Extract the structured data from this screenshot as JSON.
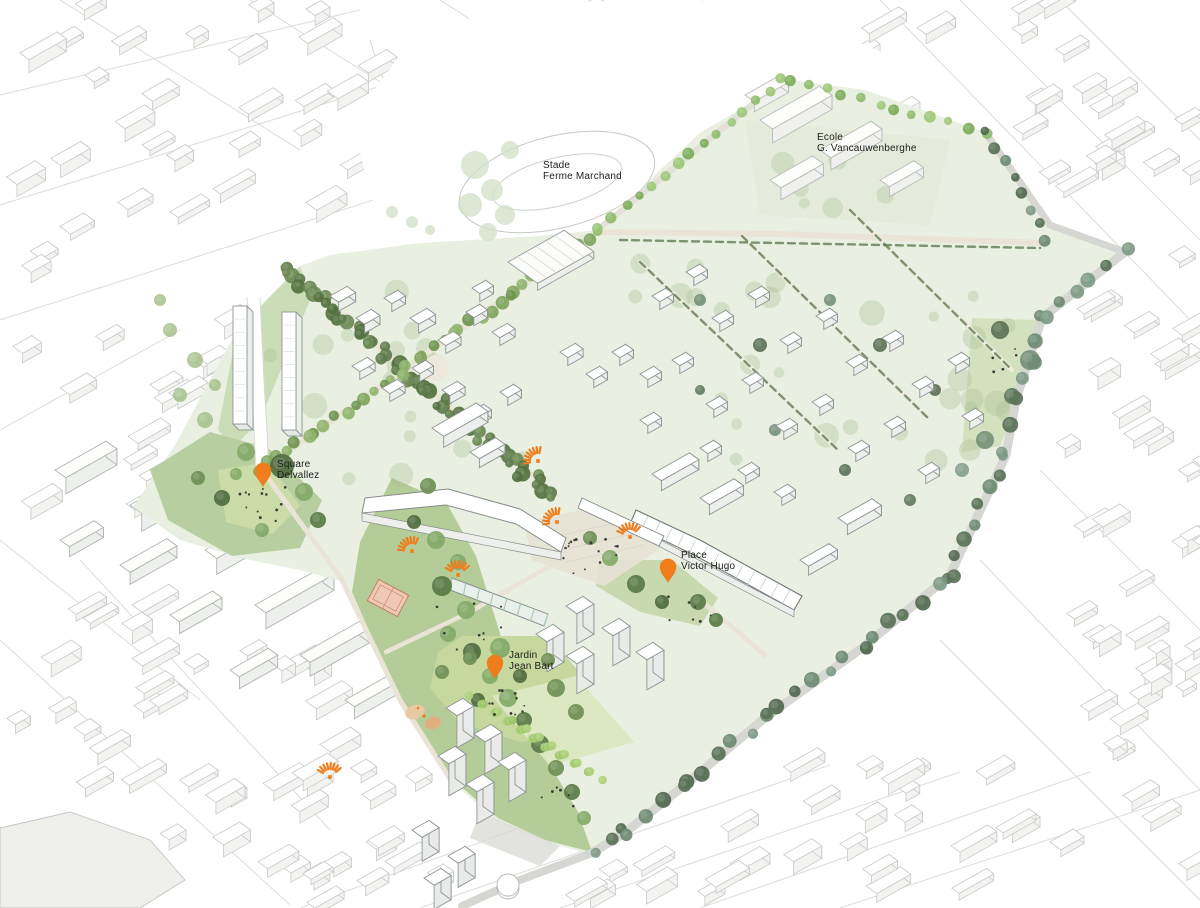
{
  "labels": {
    "stade": {
      "line1": "Stade",
      "line2": "Ferme Marchand",
      "x": 543,
      "y": 168
    },
    "ecole": {
      "line1": "Ecole",
      "line2": "G. Vancauwenberghe",
      "x": 817,
      "y": 140
    }
  },
  "pins": [
    {
      "id": "square-delvallez",
      "line1": "Square",
      "line2": "Delvallez",
      "x": 263,
      "y": 487,
      "lx": 277,
      "ly": 467
    },
    {
      "id": "place-victor-hugo",
      "line1": "Place",
      "line2": "Victor Hugo",
      "x": 668,
      "y": 583,
      "lx": 681,
      "ly": 558
    },
    {
      "id": "jardin-jean-bart",
      "line1": "Jardin",
      "line2": "Jean Bart",
      "x": 495,
      "y": 679,
      "lx": 509,
      "ly": 658
    }
  ],
  "entrance_markers": [
    {
      "x": 538,
      "y": 461,
      "dir": 135
    },
    {
      "x": 412,
      "y": 551,
      "dir": 120
    },
    {
      "x": 458,
      "y": 575,
      "dir": 95
    },
    {
      "x": 557,
      "y": 522,
      "dir": 135
    },
    {
      "x": 630,
      "y": 537,
      "dir": 100
    },
    {
      "x": 330,
      "y": 777,
      "dir": 95
    }
  ],
  "colors": {
    "accent": "#EF7D1C",
    "text": "#1D1D1B",
    "plan_wash": "#E9EFE1",
    "park": "#B7CFA0",
    "lawn": "#C6D89E",
    "avenue_dark": "#5E7C4B",
    "avenue_mid": "#7FA55D",
    "avenue_bright": "#8FBC6B",
    "boulevard": "#6E8B72",
    "court": "#F0C9B6",
    "road": "#EAE4D6",
    "fabric_line": "#C7CBC7"
  }
}
